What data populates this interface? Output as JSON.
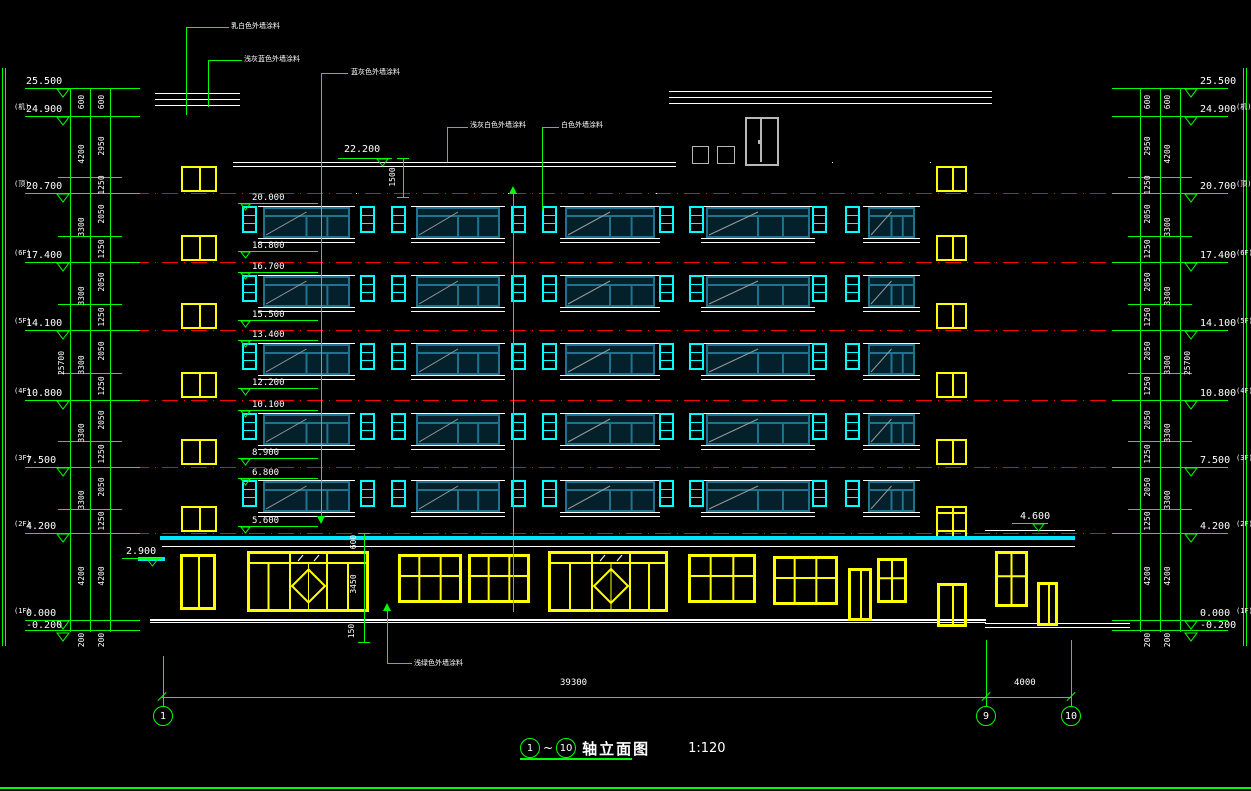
{
  "drawing_title": {
    "axis_start": "1",
    "axis_end": "10",
    "wave": "~",
    "name": "轴立面图",
    "scale": "1:120"
  },
  "colors": {
    "line": "#00ff00",
    "wall": "#ffffff",
    "floor_line": "#ff0000",
    "window_small": "#00ffff",
    "window_large": "#1d7390",
    "window_large_fill": "#04202a",
    "storefront": "#ffff00",
    "canopy": "#00e5ff",
    "penthouse": "#b8b8b8",
    "text": "#ffffff"
  },
  "levels_left": [
    {
      "prefix": "",
      "value": "25.500",
      "y": 88
    },
    {
      "prefix": "(机)",
      "value": "24.900",
      "y": 116
    },
    {
      "prefix": "(顶)",
      "value": "20.700",
      "y": 193
    },
    {
      "prefix": "(6F)",
      "value": "17.400",
      "y": 262
    },
    {
      "prefix": "(5F)",
      "value": "14.100",
      "y": 330
    },
    {
      "prefix": "(4F)",
      "value": "10.800",
      "y": 400
    },
    {
      "prefix": "(3F)",
      "value": "7.500",
      "y": 467
    },
    {
      "prefix": "(2F)",
      "value": "4.200",
      "y": 533
    },
    {
      "prefix": "(1F)",
      "value": "0.000",
      "y": 620
    },
    {
      "prefix": "",
      "value": "-0.200",
      "y": 632
    }
  ],
  "levels_right": [
    {
      "prefix": "",
      "value": "25.500",
      "y": 88
    },
    {
      "prefix": "(机)",
      "value": "24.900",
      "y": 116
    },
    {
      "prefix": "(顶)",
      "value": "20.700",
      "y": 193
    },
    {
      "prefix": "(6F)",
      "value": "17.400",
      "y": 262
    },
    {
      "prefix": "(5F)",
      "value": "14.100",
      "y": 330
    },
    {
      "prefix": "(4F)",
      "value": "10.800",
      "y": 400
    },
    {
      "prefix": "(3F)",
      "value": "7.500",
      "y": 467
    },
    {
      "prefix": "(2F)",
      "value": "4.200",
      "y": 533
    },
    {
      "prefix": "(1F)",
      "value": "0.000",
      "y": 620
    },
    {
      "prefix": "",
      "value": "-0.200",
      "y": 632
    }
  ],
  "interior_marks": [
    {
      "value": "20.000",
      "y": 194
    },
    {
      "value": "18.800",
      "y": 242
    },
    {
      "value": "16.700",
      "y": 263
    },
    {
      "value": "15.500",
      "y": 311
    },
    {
      "value": "13.400",
      "y": 331
    },
    {
      "value": "12.200",
      "y": 379
    },
    {
      "value": "10.100",
      "y": 401
    },
    {
      "value": "8.900",
      "y": 449
    },
    {
      "value": "6.800",
      "y": 469
    },
    {
      "value": "5.600",
      "y": 517
    }
  ],
  "special_marks": [
    {
      "value": "22.200",
      "x": 344,
      "y": 145,
      "lx": 338,
      "lw": 54,
      "ly": 158
    },
    {
      "value": "4.600",
      "x": 1020,
      "y": 512,
      "lx": 1012,
      "lw": 36,
      "ly": 523
    },
    {
      "value": "2.900",
      "x": 126,
      "y": 547,
      "lx": 122,
      "lw": 40,
      "ly": 558
    }
  ],
  "dim_lines_left": [
    70,
    90,
    110
  ],
  "dim_lines_right": [
    1140,
    1160,
    1180
  ],
  "dim_ticks_y": [
    88,
    116,
    177,
    193,
    236,
    262,
    304,
    330,
    373,
    400,
    441,
    467,
    509,
    533,
    620,
    630
  ],
  "level_line_ys": [
    88,
    116,
    193,
    262,
    330,
    400,
    467,
    533,
    620,
    630
  ],
  "dim_texts_left": [
    {
      "v": "25700",
      "x": 62,
      "y": 363
    },
    {
      "v": "600",
      "x": 82,
      "y": 102
    },
    {
      "v": "4200",
      "x": 82,
      "y": 154
    },
    {
      "v": "3300",
      "x": 82,
      "y": 227
    },
    {
      "v": "3300",
      "x": 82,
      "y": 296
    },
    {
      "v": "3300",
      "x": 82,
      "y": 365
    },
    {
      "v": "3300",
      "x": 82,
      "y": 433
    },
    {
      "v": "3300",
      "x": 82,
      "y": 500
    },
    {
      "v": "4200",
      "x": 82,
      "y": 576
    },
    {
      "v": "200",
      "x": 82,
      "y": 640
    },
    {
      "v": "600",
      "x": 102,
      "y": 102
    },
    {
      "v": "2950",
      "x": 102,
      "y": 146
    },
    {
      "v": "1250",
      "x": 102,
      "y": 185
    },
    {
      "v": "2050",
      "x": 102,
      "y": 214
    },
    {
      "v": "1250",
      "x": 102,
      "y": 249
    },
    {
      "v": "2050",
      "x": 102,
      "y": 282
    },
    {
      "v": "1250",
      "x": 102,
      "y": 317
    },
    {
      "v": "2050",
      "x": 102,
      "y": 351
    },
    {
      "v": "1250",
      "x": 102,
      "y": 386
    },
    {
      "v": "2050",
      "x": 102,
      "y": 420
    },
    {
      "v": "1250",
      "x": 102,
      "y": 454
    },
    {
      "v": "2050",
      "x": 102,
      "y": 487
    },
    {
      "v": "1250",
      "x": 102,
      "y": 521
    },
    {
      "v": "4200",
      "x": 102,
      "y": 576
    },
    {
      "v": "200",
      "x": 102,
      "y": 640
    }
  ],
  "dim_texts_right": [
    {
      "v": "25700",
      "x": 1188,
      "y": 363
    },
    {
      "v": "600",
      "x": 1168,
      "y": 102
    },
    {
      "v": "4200",
      "x": 1168,
      "y": 154
    },
    {
      "v": "3300",
      "x": 1168,
      "y": 227
    },
    {
      "v": "3300",
      "x": 1168,
      "y": 296
    },
    {
      "v": "3300",
      "x": 1168,
      "y": 365
    },
    {
      "v": "3300",
      "x": 1168,
      "y": 433
    },
    {
      "v": "3300",
      "x": 1168,
      "y": 500
    },
    {
      "v": "4200",
      "x": 1168,
      "y": 576
    },
    {
      "v": "200",
      "x": 1168,
      "y": 640
    },
    {
      "v": "600",
      "x": 1148,
      "y": 102
    },
    {
      "v": "2950",
      "x": 1148,
      "y": 146
    },
    {
      "v": "1250",
      "x": 1148,
      "y": 185
    },
    {
      "v": "2050",
      "x": 1148,
      "y": 214
    },
    {
      "v": "1250",
      "x": 1148,
      "y": 249
    },
    {
      "v": "2050",
      "x": 1148,
      "y": 282
    },
    {
      "v": "1250",
      "x": 1148,
      "y": 317
    },
    {
      "v": "2050",
      "x": 1148,
      "y": 351
    },
    {
      "v": "1250",
      "x": 1148,
      "y": 386
    },
    {
      "v": "2050",
      "x": 1148,
      "y": 420
    },
    {
      "v": "1250",
      "x": 1148,
      "y": 454
    },
    {
      "v": "2050",
      "x": 1148,
      "y": 487
    },
    {
      "v": "1250",
      "x": 1148,
      "y": 521
    },
    {
      "v": "4200",
      "x": 1148,
      "y": 576
    },
    {
      "v": "200",
      "x": 1148,
      "y": 640
    }
  ],
  "mid_dims": [
    {
      "v": "1500",
      "x": 393,
      "y": 177
    },
    {
      "v": "600",
      "x": 354,
      "y": 542
    },
    {
      "v": "3450",
      "x": 354,
      "y": 584
    },
    {
      "v": "150",
      "x": 352,
      "y": 631
    }
  ],
  "mid_dim_lines": [
    {
      "x": 403,
      "y1": 158,
      "y2": 197
    },
    {
      "x": 364,
      "y1": 533,
      "y2": 642
    }
  ],
  "bottom_dims": [
    {
      "v": "39300",
      "x": 560,
      "y": 687
    },
    {
      "v": "4000",
      "x": 1014,
      "y": 687
    }
  ],
  "bottom_dim_line": {
    "y": 697,
    "x1": 162,
    "x2": 1071,
    "tick_xs": [
      162,
      986,
      1071
    ]
  },
  "grid_bubbles": [
    {
      "label": "1",
      "x": 163,
      "ext_y1": 656
    },
    {
      "label": "9",
      "x": 986,
      "ext_y1": 640
    },
    {
      "label": "10",
      "x": 1071,
      "ext_y1": 640
    }
  ],
  "bubble_y": 716,
  "notes": [
    {
      "t": "乳白色外墙涂料",
      "x": 231,
      "y": 23
    },
    {
      "t": "浅灰蓝色外墙涂料",
      "x": 244,
      "y": 56
    },
    {
      "t": "蓝灰色外墙涂料",
      "x": 351,
      "y": 69
    },
    {
      "t": "浅灰白色外墙涂料",
      "x": 470,
      "y": 122
    },
    {
      "t": "白色外墙涂料",
      "x": 561,
      "y": 122
    },
    {
      "t": "浅绿色外墙涂料",
      "x": 414,
      "y": 660
    }
  ],
  "leaders": [
    {
      "vx": 186,
      "vy1": 27,
      "vy2": 115,
      "hy": 27,
      "hx1": 186,
      "hx2": 229
    },
    {
      "vx": 208,
      "vy1": 60,
      "vy2": 107,
      "hy": 60,
      "hx1": 208,
      "hx2": 242
    },
    {
      "vx": 321,
      "vy1": 73,
      "vy2": 520,
      "hy": 73,
      "hx1": 321,
      "hx2": 348,
      "arrow": "down"
    },
    {
      "vx": 447,
      "vy1": 127,
      "vy2": 162,
      "hy": 127,
      "hx1": 447,
      "hx2": 468
    },
    {
      "vx": 542,
      "vy1": 127,
      "vy2": 210,
      "hy": 127,
      "hx1": 542,
      "hx2": 559
    },
    {
      "vx": 387,
      "vy1": 607,
      "vy2": 663,
      "hy": 663,
      "hx1": 387,
      "hx2": 412,
      "arrow": "up"
    },
    {
      "vx": 513,
      "vy1": 190,
      "vy2": 612,
      "arrow": "up"
    }
  ],
  "floor_line_ys": [
    193,
    262,
    330,
    400,
    467,
    533
  ],
  "band_tops": [
    193,
    262,
    330,
    400,
    467
  ],
  "small_window_xs": [
    242,
    360,
    391,
    511,
    542,
    659,
    689,
    812,
    845
  ],
  "small_window": {
    "w": 15,
    "dy": 13,
    "h": 27
  },
  "big_windows": [
    {
      "x": 263,
      "w": 87
    },
    {
      "x": 416,
      "w": 84
    },
    {
      "x": 565,
      "w": 90
    },
    {
      "x": 706,
      "w": 104
    },
    {
      "x": 868,
      "w": 47
    }
  ],
  "big_window": {
    "dy": 14,
    "h": 31
  },
  "stair_window_tops": [
    166,
    235,
    303,
    372,
    439,
    506
  ],
  "stair_window_left": {
    "x": 181,
    "w": 36,
    "h": 26
  },
  "stair_window_right": {
    "x": 936,
    "w": 31,
    "h": 26
  },
  "stair_window_extra": {
    "x": 936,
    "y": 512,
    "w": 31,
    "h": 26
  },
  "walls": [
    {
      "x": 155,
      "y": 93,
      "w": 85,
      "h": 1
    },
    {
      "x": 155,
      "y": 99,
      "w": 85,
      "h": 1
    },
    {
      "x": 155,
      "y": 105,
      "w": 85,
      "h": 1
    },
    {
      "x": 162,
      "y": 105,
      "w": 1,
      "h": 515
    },
    {
      "x": 233,
      "y": 105,
      "w": 1,
      "h": 515
    },
    {
      "x": 233,
      "y": 162,
      "w": 443,
      "h": 1
    },
    {
      "x": 233,
      "y": 166,
      "w": 443,
      "h": 1
    },
    {
      "x": 669,
      "y": 91,
      "w": 157,
      "h": 1
    },
    {
      "x": 669,
      "y": 97,
      "w": 157,
      "h": 1
    },
    {
      "x": 669,
      "y": 103,
      "w": 157,
      "h": 1
    },
    {
      "x": 676,
      "y": 103,
      "w": 1,
      "h": 59
    },
    {
      "x": 829,
      "y": 103,
      "w": 1,
      "h": 59
    },
    {
      "x": 825,
      "y": 91,
      "w": 167,
      "h": 1
    },
    {
      "x": 825,
      "y": 97,
      "w": 167,
      "h": 1
    },
    {
      "x": 825,
      "y": 103,
      "w": 167,
      "h": 1
    },
    {
      "x": 985,
      "y": 103,
      "w": 1,
      "h": 517
    },
    {
      "x": 832,
      "y": 162,
      "w": 1,
      "h": 458
    },
    {
      "x": 930,
      "y": 162,
      "w": 1,
      "h": 458
    },
    {
      "x": 356,
      "y": 193,
      "w": 1,
      "h": 427
    },
    {
      "x": 508,
      "y": 193,
      "w": 1,
      "h": 427
    },
    {
      "x": 656,
      "y": 193,
      "w": 1,
      "h": 427
    },
    {
      "x": 150,
      "y": 619,
      "w": 836,
      "h": 2
    },
    {
      "x": 150,
      "y": 622,
      "w": 836,
      "h": 1
    },
    {
      "x": 985,
      "y": 623,
      "w": 145,
      "h": 1
    },
    {
      "x": 985,
      "y": 627,
      "w": 145,
      "h": 1
    },
    {
      "x": 985,
      "y": 530,
      "w": 90,
      "h": 1
    },
    {
      "x": 1071,
      "y": 530,
      "w": 1,
      "h": 95
    },
    {
      "x": 162,
      "y": 546,
      "w": 913,
      "h": 1
    }
  ],
  "penthouse": {
    "door": {
      "x": 745,
      "y": 117,
      "w": 30,
      "h": 45
    },
    "boxes": [
      {
        "x": 692,
        "y": 146,
        "w": 15,
        "h": 16
      },
      {
        "x": 717,
        "y": 146,
        "w": 16,
        "h": 16
      }
    ]
  },
  "canopy": {
    "x": 160,
    "y": 536,
    "w": 915,
    "h": 4
  },
  "mini_canopy": {
    "x": 138,
    "y": 557,
    "w": 27,
    "h": 4
  },
  "storefronts": [
    {
      "kind": "door",
      "x": 180,
      "w": 36,
      "y": 554,
      "h": 56
    },
    {
      "kind": "diamond-shop",
      "x": 247,
      "w": 122,
      "y": 551,
      "h": 61,
      "door_x": 290,
      "door_w": 37
    },
    {
      "kind": "grid",
      "x": 398,
      "w": 64,
      "y": 554,
      "h": 49,
      "cols": 3
    },
    {
      "kind": "grid",
      "x": 468,
      "w": 62,
      "y": 554,
      "h": 49,
      "cols": 3
    },
    {
      "kind": "diamond-shop",
      "x": 548,
      "w": 120,
      "y": 551,
      "h": 61,
      "door_x": 592,
      "door_w": 38
    },
    {
      "kind": "grid",
      "x": 688,
      "w": 68,
      "y": 554,
      "h": 49,
      "cols": 3
    },
    {
      "kind": "grid",
      "x": 773,
      "w": 65,
      "y": 556,
      "h": 49,
      "cols": 3
    },
    {
      "kind": "door",
      "x": 848,
      "w": 24,
      "y": 568,
      "h": 53
    },
    {
      "kind": "grid",
      "x": 877,
      "w": 30,
      "y": 558,
      "h": 45,
      "cols": 2
    },
    {
      "kind": "door",
      "x": 937,
      "w": 30,
      "y": 583,
      "h": 44
    },
    {
      "kind": "grid",
      "x": 995,
      "w": 33,
      "y": 551,
      "h": 56,
      "cols": 2
    },
    {
      "kind": "door",
      "x": 1037,
      "w": 21,
      "y": 582,
      "h": 44
    }
  ],
  "borders": {
    "left_x": [
      2,
      5
    ],
    "right_x": [
      1243,
      1246
    ],
    "v_y1": 68,
    "v_y2": 646,
    "bottom_y": 787
  }
}
